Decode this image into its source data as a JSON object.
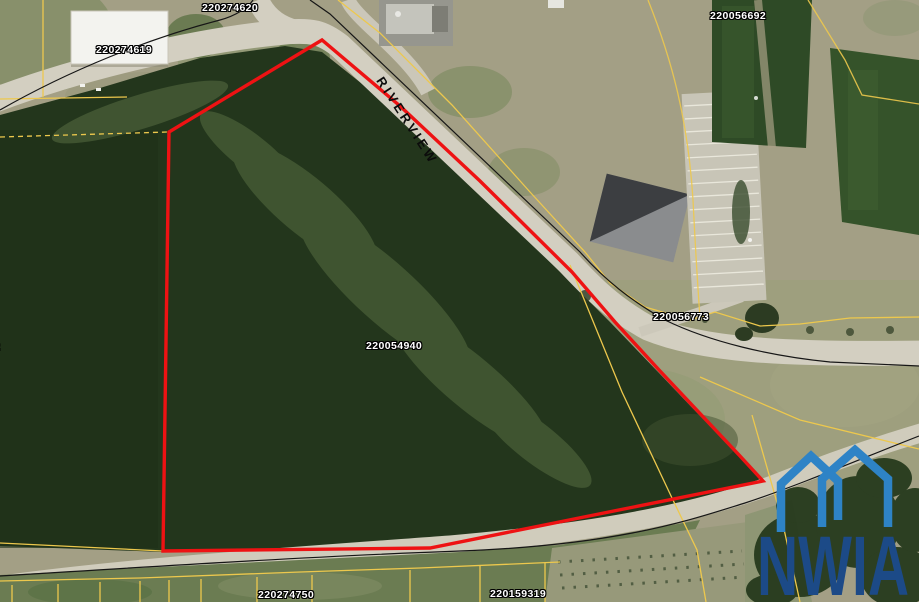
{
  "map": {
    "road_label": "RIVERVIEW",
    "parcel_labels": [
      "220274620",
      "220274619",
      "220056692",
      "220056773",
      "220054940",
      "220274750",
      "220159319"
    ],
    "partial_parcel_label": "2"
  },
  "logo": {
    "text": "NWIA"
  },
  "colors": {
    "parcel_highlight": "#ee1213",
    "parcel_line": "#edc84d",
    "road_line": "#161616",
    "logo_house": "#2e83c6",
    "logo_text": "#1c4a87"
  }
}
